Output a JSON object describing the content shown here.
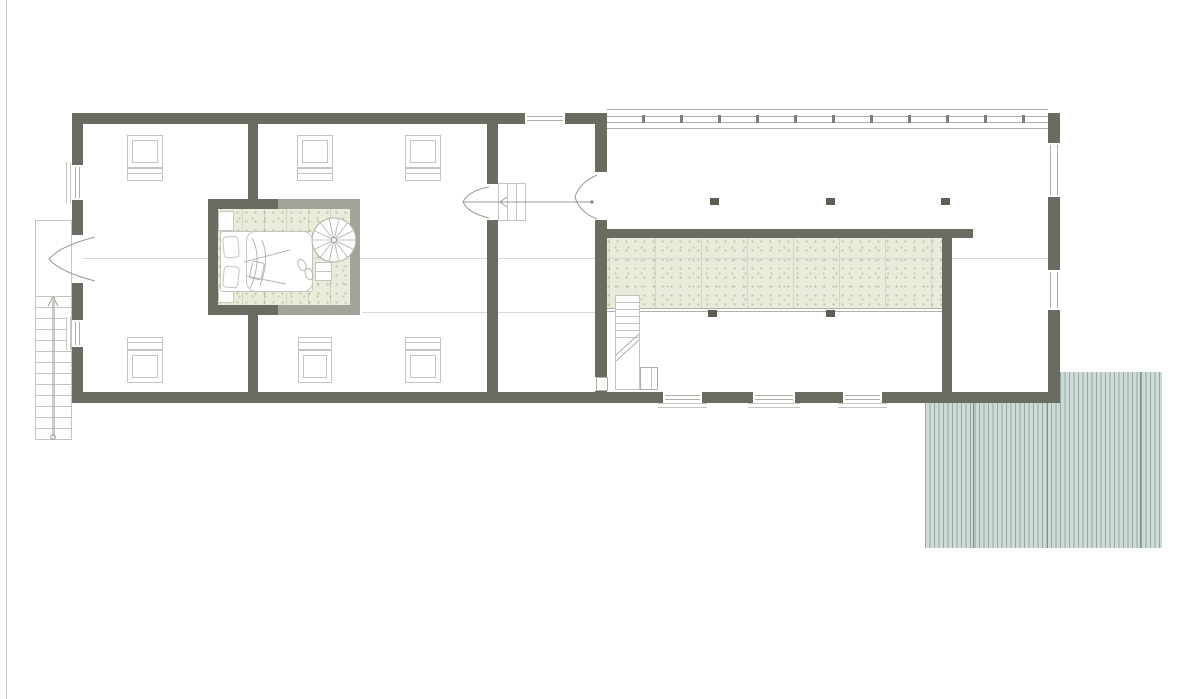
{
  "canvas": {
    "width_px": 1202,
    "height_px": 699,
    "background": "#ffffff"
  },
  "palette": {
    "background": "#ffffff",
    "wall": "#696c60",
    "glass_partition": "#a2a49a",
    "outline": "#aeafa7",
    "outline_light": "#c4c5be",
    "faint_line": "#d9dad3",
    "carpet_base": "#e9ecda",
    "carpet_speckle": "#bcc4a2",
    "deck_base": "#cedad6",
    "deck_stripe": "#94a8a4",
    "deck_divider": "#7e918d",
    "column": "#5b5e53",
    "mullion": "#7d7f75",
    "page_edge": "#c6c6c6"
  },
  "legend": {
    "drawing_type_symbols": [
      "exterior-wall",
      "glass-partition",
      "window",
      "door-swing",
      "roof-window",
      "straight-staircase",
      "spiral-staircase",
      "bed",
      "carpet",
      "wood-deck",
      "column",
      "glazed-facade",
      "ridge-line"
    ]
  },
  "deck": {
    "x": 925,
    "y": 372,
    "w": 237,
    "h": 176,
    "dividers": [
      48,
      122,
      215
    ]
  },
  "glazed_facade": {
    "x": 607,
    "w": 441,
    "line_ys": [
      109,
      116,
      122,
      128
    ],
    "mullions": [
      643,
      681,
      719,
      757,
      795,
      833,
      871,
      909,
      947,
      985,
      1023
    ]
  },
  "columns": [
    {
      "x": 710,
      "y": 198
    },
    {
      "x": 826,
      "y": 198
    },
    {
      "x": 941,
      "y": 198
    },
    {
      "x": 708,
      "y": 310
    },
    {
      "x": 826,
      "y": 310
    }
  ],
  "roof_windows": [
    {
      "x": 127,
      "win_y": 135,
      "sill_y": 168,
      "w": 36
    },
    {
      "x": 297,
      "win_y": 135,
      "sill_y": 168,
      "w": 36
    },
    {
      "x": 405,
      "win_y": 135,
      "sill_y": 168,
      "w": 36
    },
    {
      "x": 127,
      "win_y": 350,
      "sill_y": 337,
      "w": 36
    },
    {
      "x": 298,
      "win_y": 350,
      "sill_y": 337,
      "w": 34
    },
    {
      "x": 405,
      "win_y": 350,
      "sill_y": 337,
      "w": 36
    }
  ],
  "windows": [
    {
      "id": "north-window",
      "x": 525,
      "y": 113,
      "w": 40,
      "h": 11,
      "dir": "h"
    },
    {
      "id": "south-window-1",
      "x": 663,
      "y": 392,
      "w": 39,
      "h": 11,
      "dir": "h",
      "sill": {
        "x": 658,
        "y": 403,
        "w": 49,
        "h": 5
      }
    },
    {
      "id": "south-window-2",
      "x": 753,
      "y": 392,
      "w": 42,
      "h": 11,
      "dir": "h",
      "sill": {
        "x": 748,
        "y": 403,
        "w": 52,
        "h": 5
      }
    },
    {
      "id": "south-window-3",
      "x": 843,
      "y": 392,
      "w": 39,
      "h": 11,
      "dir": "h",
      "sill": {
        "x": 838,
        "y": 403,
        "w": 49,
        "h": 5
      }
    },
    {
      "id": "west-window-1",
      "x": 72,
      "y": 165,
      "w": 11,
      "h": 35,
      "dir": "v",
      "sill": {
        "x": 66,
        "y": 162,
        "w": 5,
        "h": 41
      }
    },
    {
      "id": "west-window-2",
      "x": 72,
      "y": 320,
      "w": 11,
      "h": 27,
      "dir": "v",
      "sill": {
        "x": 66,
        "y": 317,
        "w": 5,
        "h": 33
      }
    },
    {
      "id": "east-window-1",
      "x": 1047,
      "y": 143,
      "w": 14,
      "h": 54,
      "dir": "v"
    },
    {
      "id": "east-window-2",
      "x": 1047,
      "y": 270,
      "w": 14,
      "h": 40,
      "dir": "v"
    }
  ],
  "door_openings": [
    {
      "id": "west-entry-door",
      "x": 72,
      "y": 235,
      "w": 11,
      "h": 48
    },
    {
      "id": "bedroom-hall-door",
      "x": 487,
      "y": 184,
      "w": 11,
      "h": 36
    },
    {
      "id": "hall-living-door",
      "x": 595,
      "y": 172,
      "w": 12,
      "h": 48
    },
    {
      "id": "hall-lower-door",
      "x": 596,
      "y": 377,
      "w": 12,
      "h": 14,
      "framed": true
    }
  ],
  "exterior_stair": {
    "x": 35,
    "y": 220,
    "w": 37,
    "h": 220,
    "tread_start": 295,
    "tread_end": 438,
    "step": 11,
    "rail_x": 53
  },
  "interior_stair": {
    "x": 615,
    "y": 295,
    "w": 25,
    "h": 95,
    "treads": [
      301,
      308,
      315,
      322,
      329,
      336
    ],
    "closet": {
      "x": 640,
      "y": 367,
      "w": 18,
      "h": 23,
      "line_x": 650
    }
  },
  "hall_stair": {
    "x": 498,
    "y": 183,
    "w": 28,
    "h": 38,
    "treads_x": [
      506,
      515,
      524
    ]
  },
  "spiral_stair": {
    "cx": 334,
    "cy": 240,
    "r": 22,
    "spokes": 14
  }
}
